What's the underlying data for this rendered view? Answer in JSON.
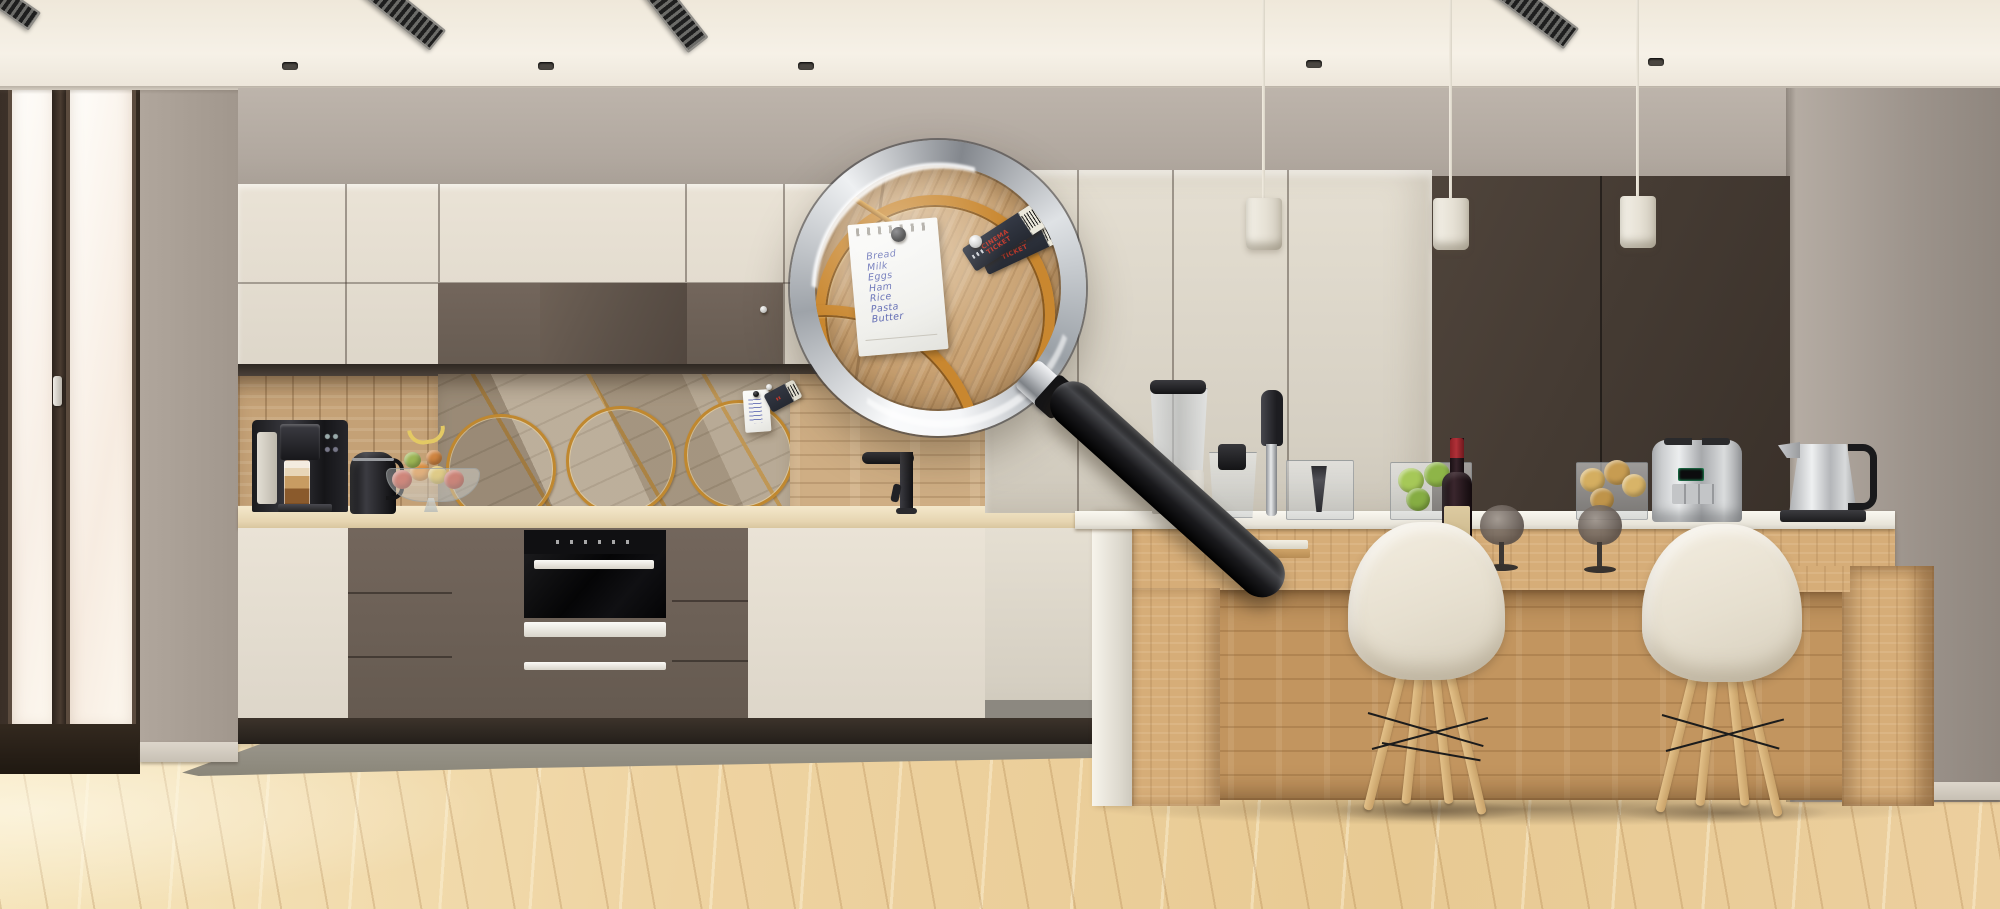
{
  "scene": {
    "description": "modern kitchen interior inspected through a magnifying glass",
    "objects": [
      "glass-door",
      "ceiling-vents",
      "recessed-spots",
      "pendant-lamps",
      "upper-cabinets",
      "extractor-hood-cabinet",
      "marquetry-backsplash",
      "coffee-machine",
      "black-kettle",
      "fruit-bowl",
      "faucet",
      "built-in-oven",
      "tall-cabinets",
      "kitchen-island",
      "blender",
      "food-processor-cups",
      "stick-blender",
      "green-apples",
      "wine-bottle",
      "wine-glasses",
      "pears",
      "toaster",
      "steel-kettle",
      "eames-chairs",
      "runner-rug",
      "wood-floor",
      "magnifying-glass",
      "shopping-note",
      "cinema-tickets"
    ]
  },
  "palette": {
    "gold": "#c0882f",
    "ink": "#5560ae",
    "ticket_red": "#c23b2e",
    "cream_cabinet": "#e7e0d3",
    "taupe_cabinet": "#6b5e55",
    "dark_cabinet": "#463c33",
    "backsplash_wood": "#c9a87c",
    "island_wood": "#d2a873",
    "floor_wood": "#edd2a2",
    "wall": "#b6ada4",
    "ceiling": "#f2ede3",
    "rug": "#8f8b81",
    "steel": "#cfd1d3",
    "chair_shell": "#eee7d8",
    "wine_cap_red": "#8e2026"
  },
  "magnifier": {
    "note": {
      "items": [
        "Bread",
        "Milk",
        "Eggs",
        "Ham",
        "Rice",
        "Pasta",
        "Butter"
      ]
    },
    "tickets": {
      "count": 2,
      "line1": "CINEMA",
      "line2": "TICKET"
    }
  }
}
